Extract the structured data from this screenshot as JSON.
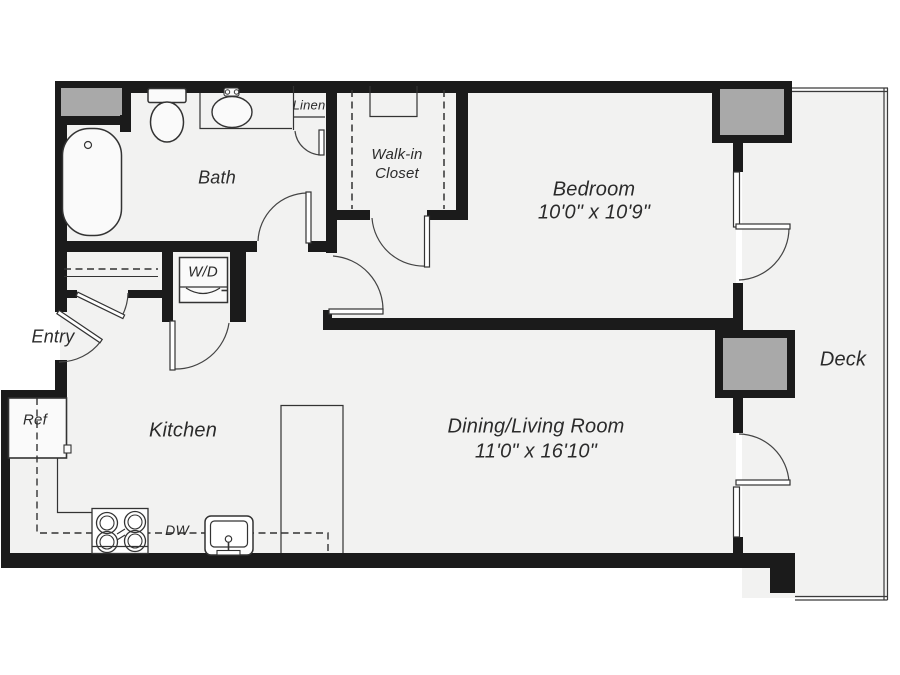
{
  "floorplan": {
    "rooms": {
      "bath": {
        "label": "Bath"
      },
      "linen": {
        "label": "Linen"
      },
      "walk_in_closet": {
        "label_line1": "Walk-in",
        "label_line2": "Closet"
      },
      "bedroom": {
        "label": "Bedroom",
        "dimensions": "10'0\" x 10'9\""
      },
      "entry": {
        "label": "Entry"
      },
      "kitchen": {
        "label": "Kitchen"
      },
      "dining_living": {
        "label": "Dining/Living Room",
        "dimensions": "11'0\" x 16'10\""
      },
      "deck": {
        "label": "Deck"
      }
    },
    "appliances": {
      "washer_dryer": {
        "label": "W/D"
      },
      "refrigerator": {
        "label": "Ref"
      },
      "dishwasher": {
        "label": "DW"
      }
    },
    "colors": {
      "wall": "#1b1b1b",
      "floor": "#f2f2f1",
      "column_fill": "#a9a9a9",
      "thin_line": "#3a3a3a"
    }
  }
}
